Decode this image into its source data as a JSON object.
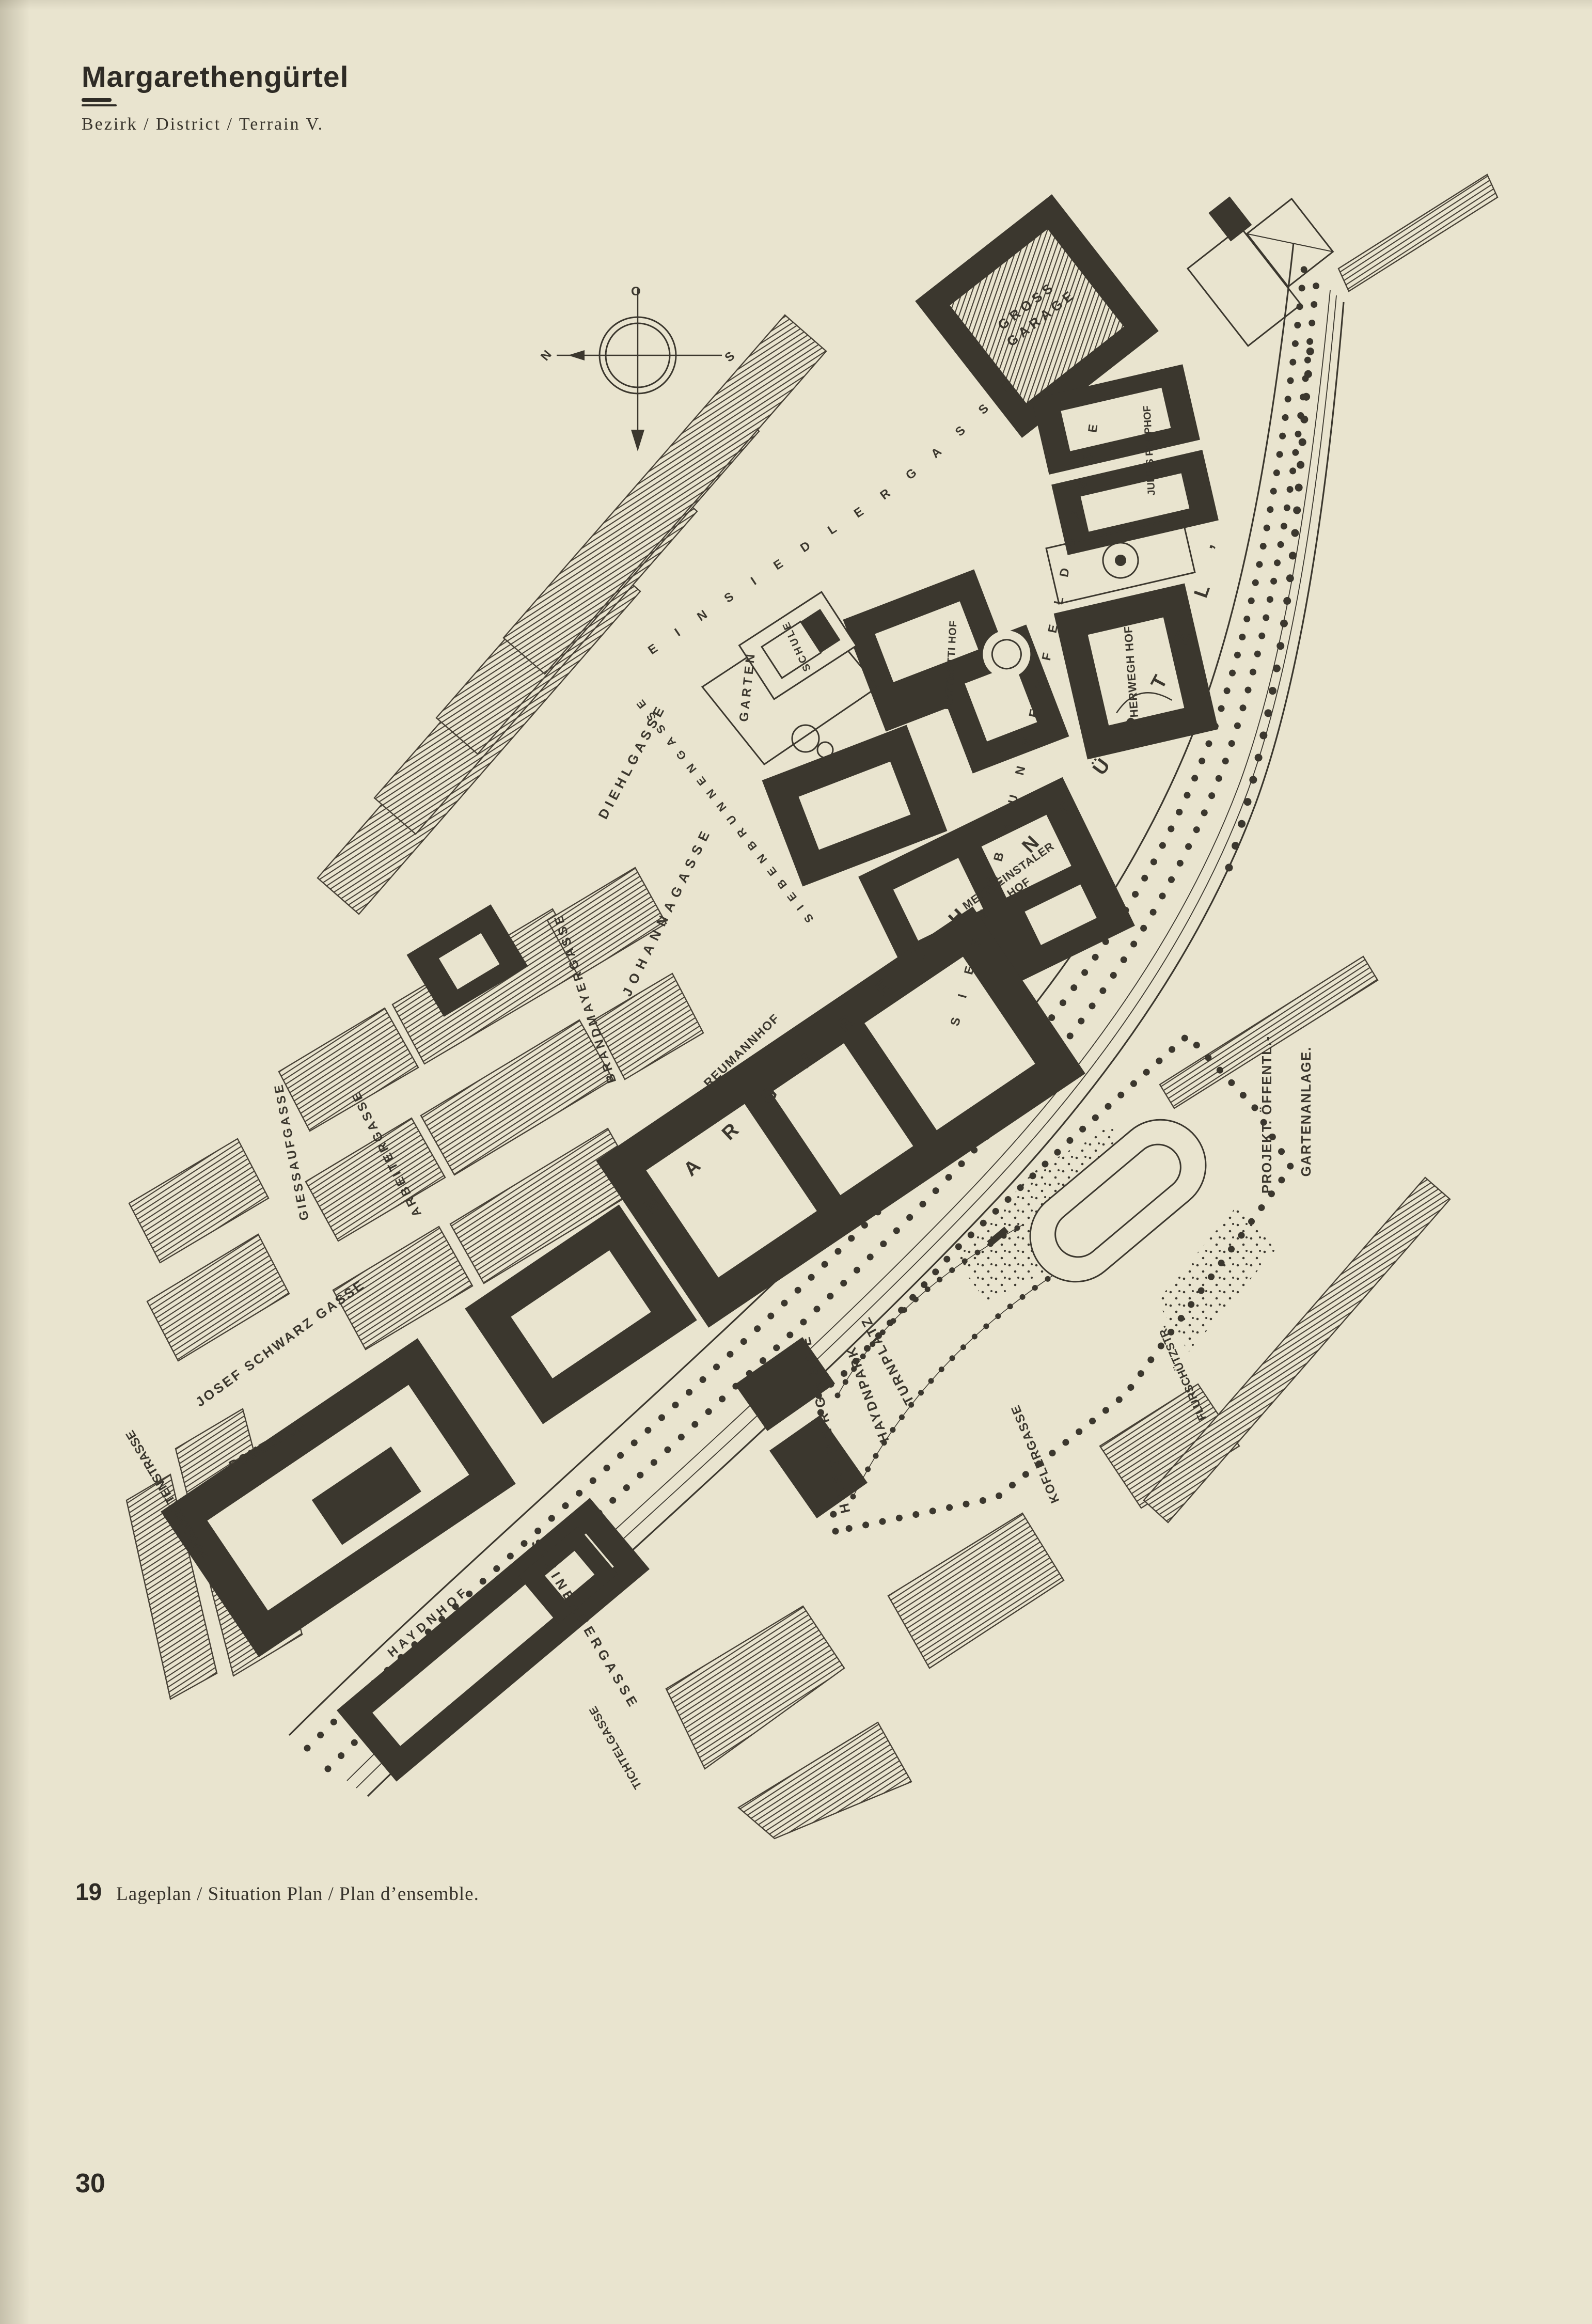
{
  "header": {
    "title": "Margarethengürtel",
    "subtitle": "Bezirk / District / Terrain V."
  },
  "figure": {
    "number": "19",
    "caption": "Lageplan / Situation Plan / Plan d’ensemble."
  },
  "page_number": "30",
  "compass": {
    "top": "O",
    "left": "N",
    "right": "S"
  },
  "colors": {
    "paper": "#e9e4cf",
    "ink": "#3b372e",
    "hatch": "#474136"
  },
  "map": {
    "band": {
      "name": "MARGARETHENGÜRTEL’"
    },
    "streets": {
      "einsiedlergasse": "EINSIEDLERGASSE",
      "siebenbrunnenfeldgasse": "SIEBENBRUNNENFELDGASSE",
      "siebenbrunnengasse": "SIEBENBRUNNENGASSE",
      "diehlgasse": "DIEHLGASSE",
      "johannagasse": "JOHANNAGASSE",
      "brandmayergasse": "BRANDMAYERGASSE",
      "arbeitergasse": "ARBEITERGASSE",
      "giessaufgasse": "GIESSAUFGASSE",
      "josef_schwarz_gasse": "JOSEF SCHWARZ GASSE",
      "margaretenstrasse": "MARGARETENSTRASSE",
      "steinbauergasse": "STEINBAUERGASSE",
      "tichtelgasse": "TICHTELGASSE",
      "herthergasse": "HERTHERGASSE",
      "koflergasse": "KOFLERGASSE",
      "flurschuetzstrasse": "FLURSCHÜTZSTR."
    },
    "buildings": {
      "gross_garage": {
        "line1": "GROSS",
        "line2": "GARAGE"
      },
      "julius_popphof": "JULIUS POPPHOF",
      "herwegh_hof": "HERWEGH HOF",
      "matteotti_hof": "MATTEOTTI HOF",
      "schule": "SCHULE",
      "metzleinstaler_hof": {
        "line1": "METZLEINSTALER",
        "line2": "HOF"
      },
      "reumannhof": "REUMANNHOF",
      "domeshof": "DOMESHOF",
      "haydnhof": "HAYDNHOF"
    },
    "areas": {
      "garten": "GARTEN",
      "haydnpark": "HAYDNPARK",
      "turnplatz": "TURNPLATZ",
      "projekt_line1": "PROJEKT. ÖFFENTL.-",
      "projekt_line2": "GARTENANLAGE."
    }
  }
}
